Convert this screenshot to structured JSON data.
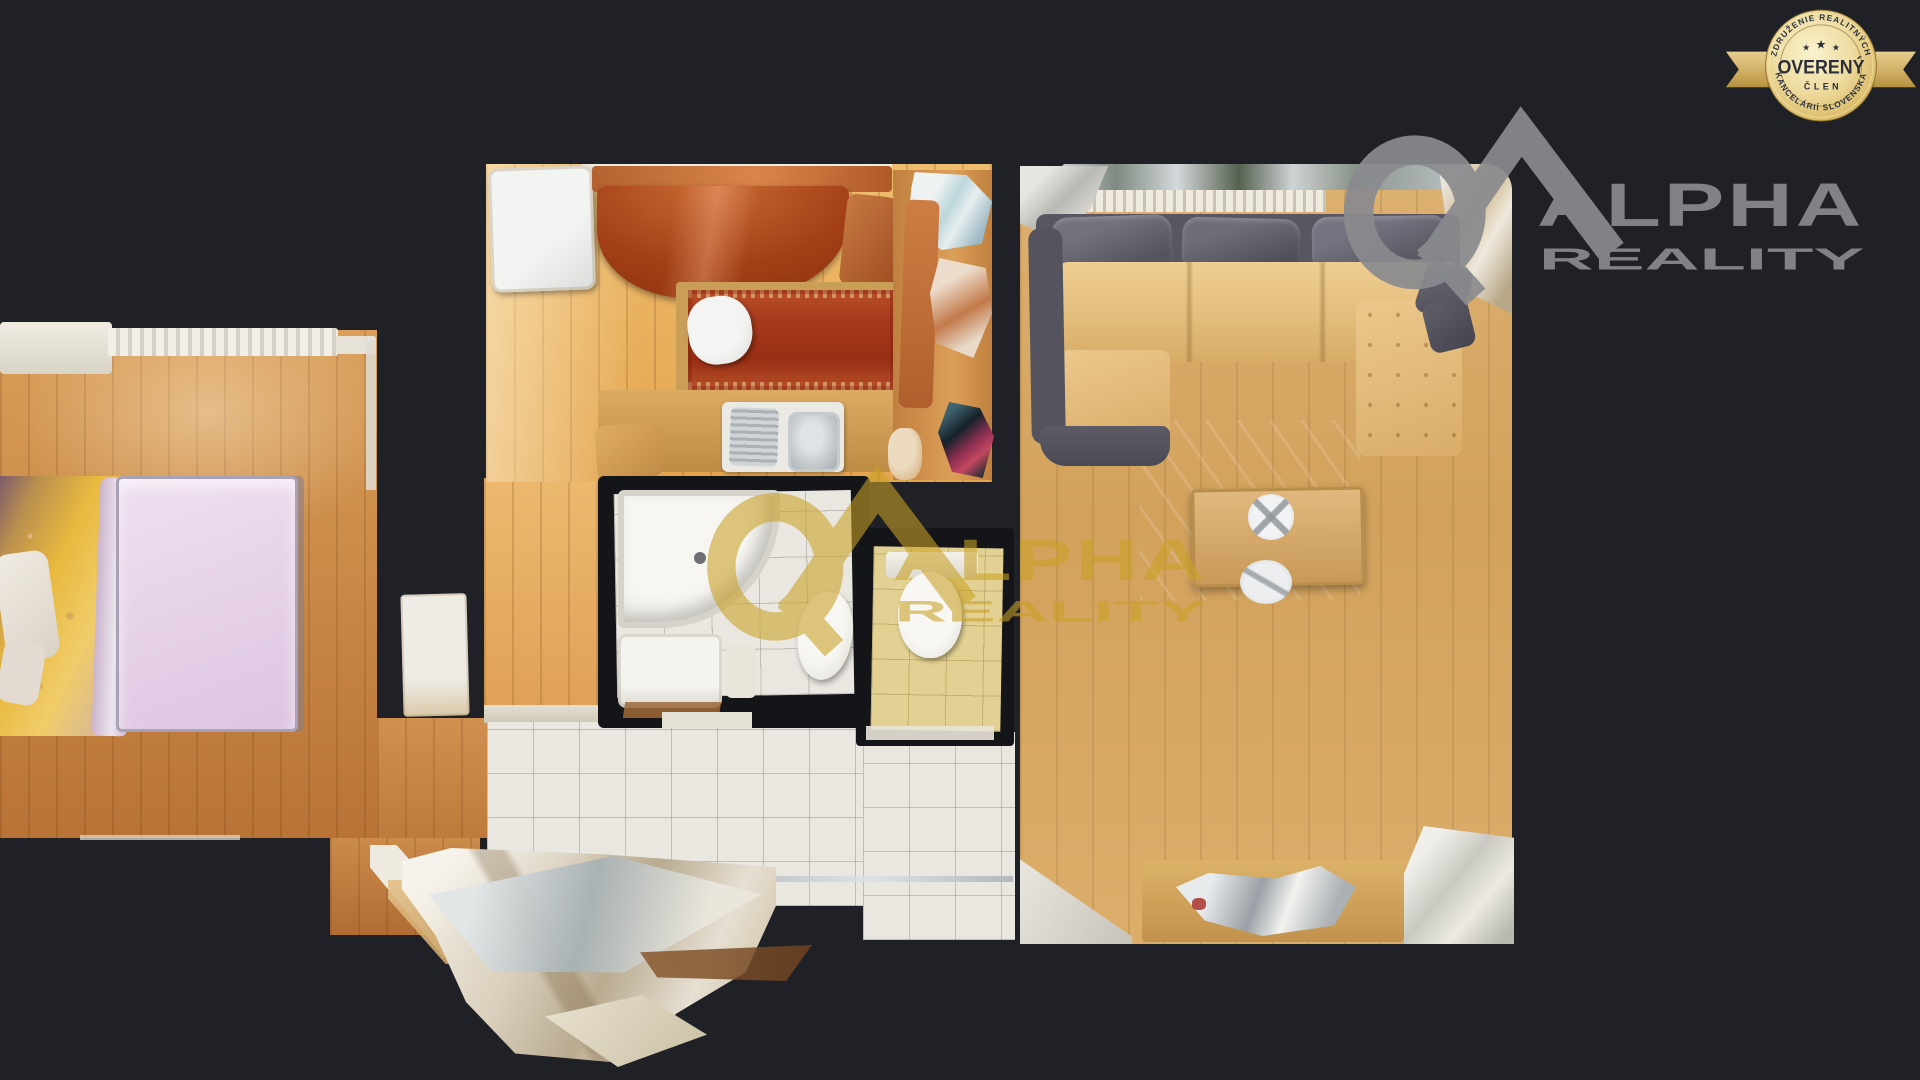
{
  "badge": {
    "arc_top": "ZDRUŽENIE REALITNÝCH",
    "star": "★",
    "title": "OVERENÝ",
    "subtitle": "ČLEN",
    "arc_bottom": "KANCELÁRIÍ SLOVENSKA"
  },
  "brand_logo": {
    "name": "ALPHA",
    "suffix": "REALITY"
  },
  "watermark_logo": {
    "name": "ALPHA",
    "suffix": "REALITY"
  },
  "palette": {
    "background": "#1f2126",
    "wall": "#141519",
    "badge_gold": "#e3c878",
    "logo_gray": "#8a8b8f",
    "watermark_gold": "#c9a125",
    "wood_bedroom": "#c9894a",
    "wood_kitchen": "#e8b066",
    "wood_living": "#d9ad6a",
    "tile_white": "#eae7e1",
    "tile_yellow": "#e2d192",
    "rug_red": "#a63a1c",
    "sofa_tan": "#e6c286",
    "sofa_gray": "#585761",
    "mattress_lilac": "#e6d4e8",
    "blanket_gold": "#e9b93f"
  }
}
